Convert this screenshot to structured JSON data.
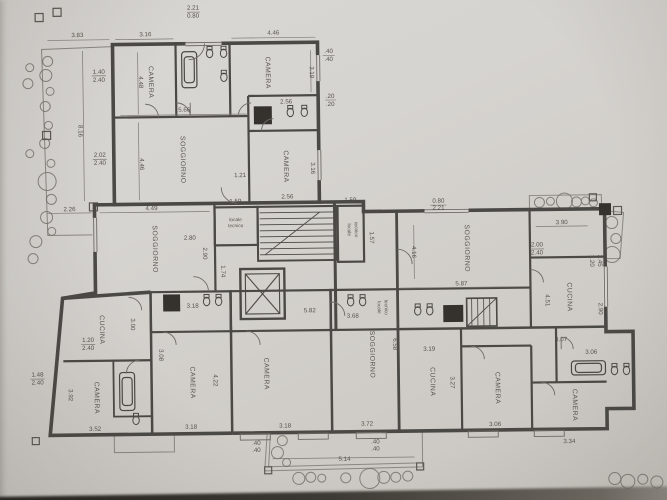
{
  "labels": {
    "camera": "CAMERA",
    "soggiorno": "SOGGIORNO",
    "cucina": "CUCINA",
    "locale": "locale",
    "tecnico": "tecnico"
  },
  "dims": [
    "2.21",
    "0.80",
    "3.83",
    "3.16",
    "4.46",
    "3.19",
    ".40",
    ".40",
    "1.40",
    "2.40",
    "4.48",
    "5.66",
    "2.02",
    "2.40",
    "4.46",
    "2.56",
    ".20",
    ".20",
    "3.16",
    "2.56",
    "1.21",
    "8.16",
    "2.26",
    "4.49",
    "1.59",
    "2.80",
    "2.90",
    "1.74",
    "1.59",
    "1.57",
    "0.80",
    "2.21",
    "3.90",
    "2.00",
    "2.40",
    "5.87",
    "4.16",
    "6.58",
    "1.20",
    "2.45",
    "2.90",
    "3.19",
    "3.68",
    "5.82",
    "3.18",
    "1.20",
    "2.40",
    "3.00",
    "1.48",
    "2.40",
    "3.92",
    "3.52",
    "3.08",
    "4.22",
    "3.18",
    "3.18",
    "3.72",
    "5.14",
    "3.27",
    "3.06",
    "3.34",
    "4.07",
    "3.06",
    ".40",
    ".40",
    ".40",
    ".40",
    "4.51"
  ],
  "icons": {
    "elevator": "box-with-x",
    "stairs": "tread-lines",
    "bathtub": "rounded-rect",
    "toilet": "ellipse-with-tank",
    "shaft": "filled-dark-square",
    "plant": "circle-cluster",
    "post": "small-square"
  },
  "colors": {
    "paper": "#d5d3cf",
    "ink": "#4b4945",
    "thin_line": "#8a8781",
    "dim_text": "#55524c",
    "shaft_fill": "#35322e",
    "scan_edge": "#2a2724"
  }
}
